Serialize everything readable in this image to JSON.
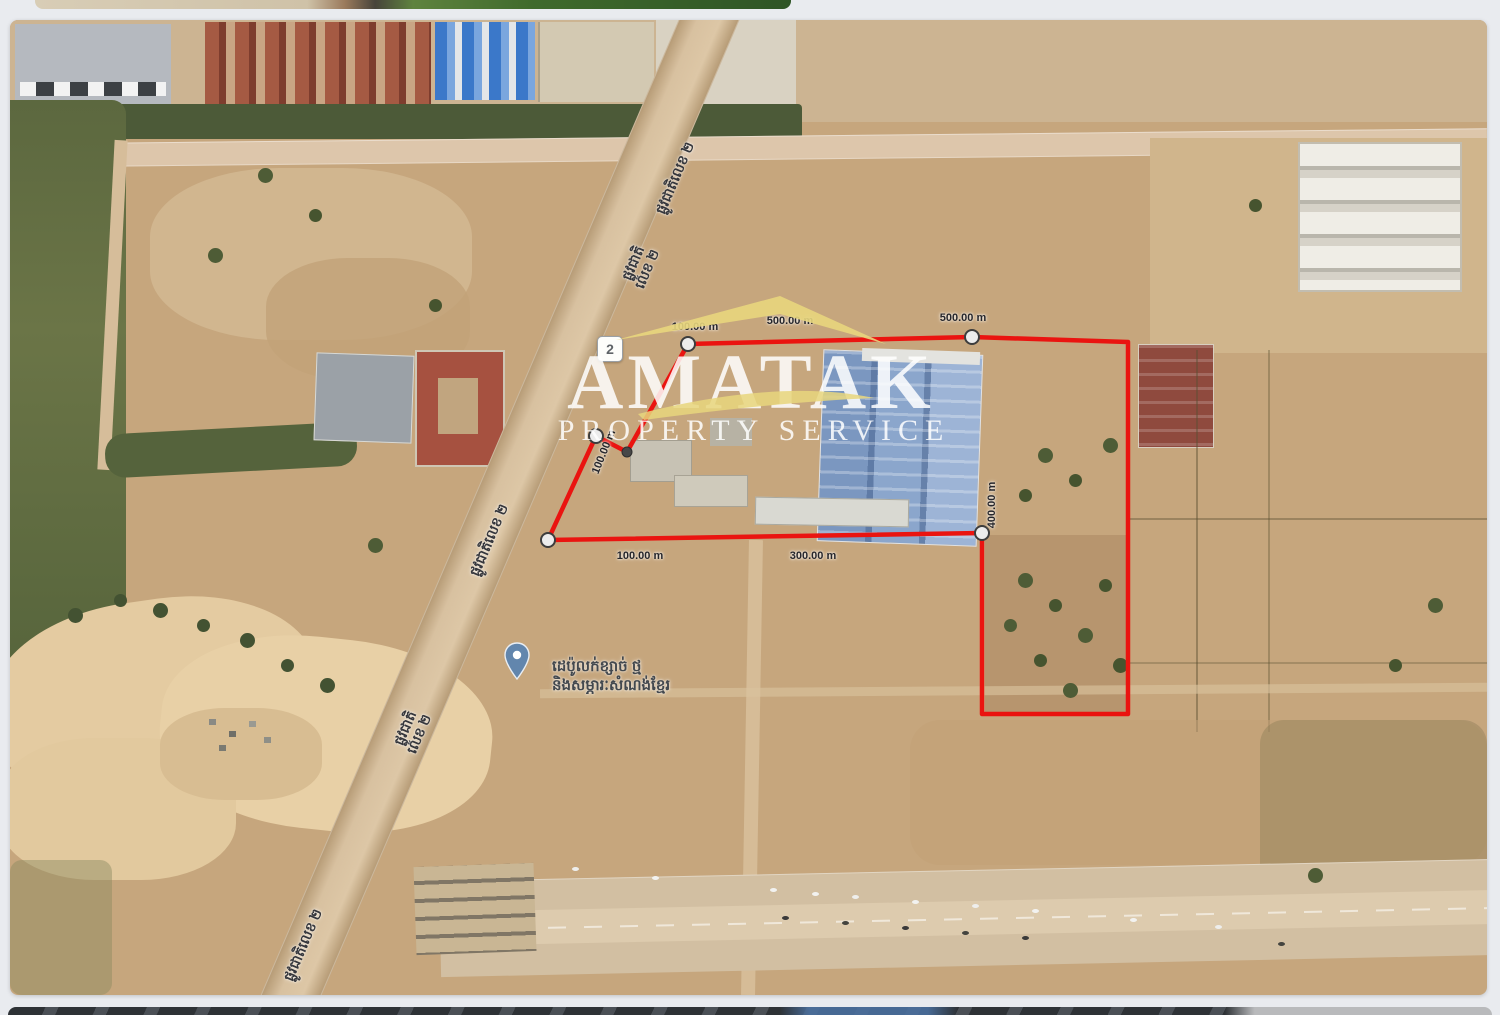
{
  "page": {
    "background": "#e9ebef"
  },
  "watermark": {
    "name": "AMATAK",
    "tagline": "PROPERTY SERVICE",
    "accent_color": "#e8d67d",
    "text_color": "#ffffff"
  },
  "map": {
    "route_shield": "2",
    "boundary_color": "#ea1410",
    "road_name": "ផ្លូវជាតិលេខ ២",
    "road_name_line1": "ផ្លូវជាតិ",
    "road_name_line2": "លេខ ២",
    "poi": {
      "label_line1": "ដេប៉ូលក់ខ្សាច់ ថ្ម",
      "label_line2": "និងសម្ភារៈសំណង់ខ្មែរ"
    },
    "measurements": [
      {
        "text": "100.00 m"
      },
      {
        "text": "500.00 m"
      },
      {
        "text": "500.00 m"
      },
      {
        "text": "100.00 m"
      },
      {
        "text": "400.00 m"
      },
      {
        "text": "100.00 m"
      },
      {
        "text": "300.00 m"
      }
    ]
  }
}
